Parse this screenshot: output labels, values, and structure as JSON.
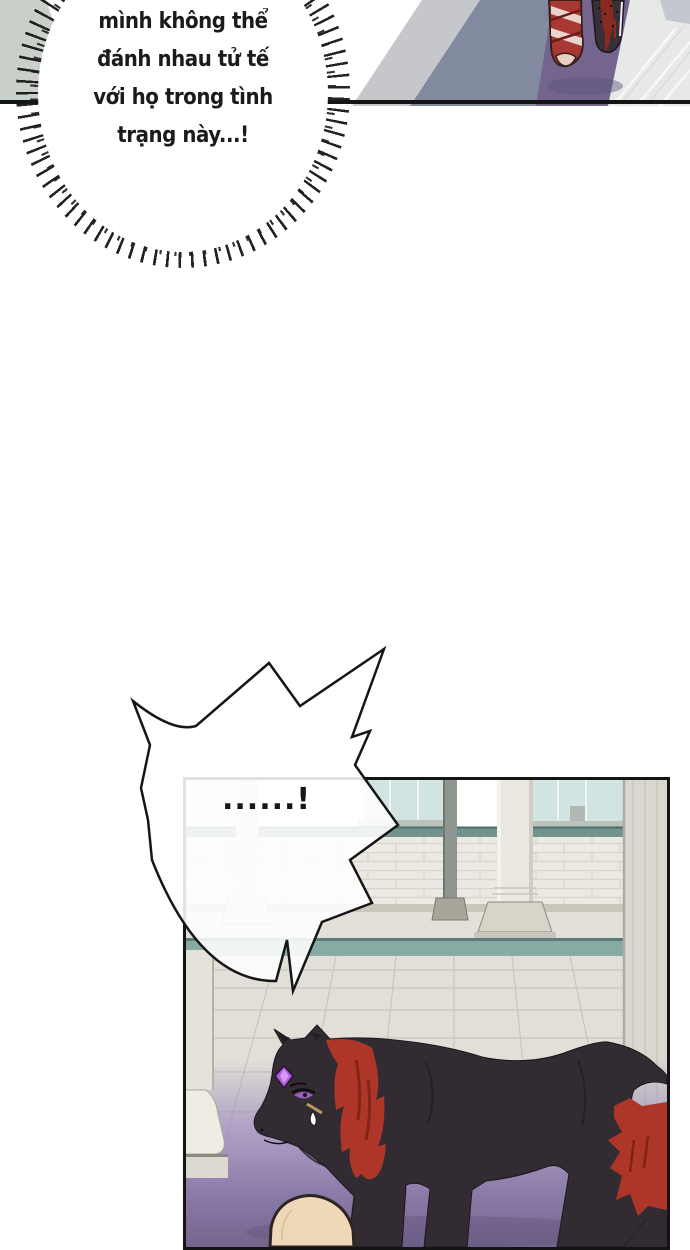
{
  "page": {
    "width": 690,
    "height": 1250,
    "background": "#ffffff"
  },
  "speech": {
    "burst_bubble": {
      "lines": [
        "mình không thể",
        "đánh nhau tử tế",
        "với họ trong tình",
        "trạng này...!"
      ]
    },
    "spiky_bubble": {
      "text": "......!"
    }
  },
  "palette": {
    "ink": "#161616",
    "panel_border": "#141414",
    "wall_corner": "#c9d0c9",
    "floor_blue_gray": "#828aa0",
    "floor_purple": "#73658e",
    "tile_white": "#e7e9e7",
    "bandage_red": "#a93832",
    "foot_dark": "#382f37",
    "brick_wall": "#ece9e2",
    "coping_teal": "#70938e",
    "water_band": "#87aaa5",
    "courtyard_tile": "#e2dfd8",
    "floor_purple_gradient": "#84749f",
    "panther_body": "#332b32",
    "blood": "#ae3628",
    "gem": "#b05ce0",
    "eye": "#9a5fc0",
    "skin": "#efd8b8",
    "window_sky": "#d2e4e1"
  }
}
